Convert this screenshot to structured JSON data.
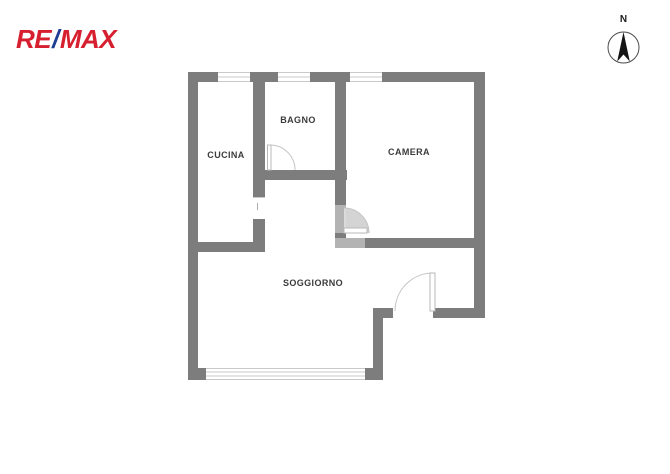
{
  "brand": {
    "re": "RE",
    "slash": "/",
    "max": "MAX"
  },
  "compass": {
    "north_label": "N"
  },
  "colors": {
    "brand_red": "#d6202f",
    "brand_blue": "#1f3e94",
    "wall": "#7d7d7d",
    "label_text": "#3b3b3b",
    "window_line": "#c9c9c9",
    "door_arc": "#c3c3c3",
    "door_swing_fill": "#cccccc"
  },
  "floorplan": {
    "rooms": [
      {
        "name": "cucina",
        "label": "CUCINA"
      },
      {
        "name": "bagno",
        "label": "BAGNO"
      },
      {
        "name": "camera",
        "label": "CAMERA"
      },
      {
        "name": "soggiorno",
        "label": "SOGGIORNO"
      }
    ]
  }
}
